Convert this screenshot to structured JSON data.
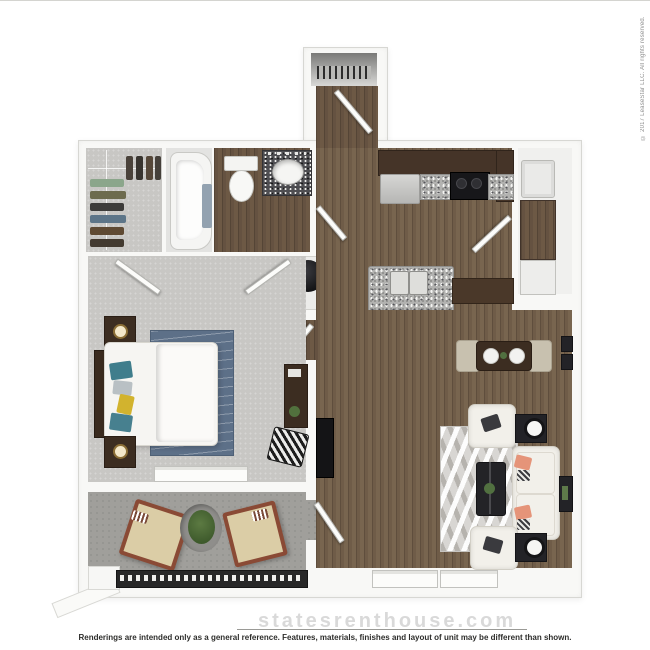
{
  "copyright": "© 2017 LeaseStar LLC. All rights reserved.",
  "footer": {
    "watermark": "statesrenthouse.com",
    "disclaimer": "Renderings are intended only as a general reference. Features, materials, finishes and layout of unit may be different than shown."
  },
  "floorplan": {
    "view": "3d-top-down-rendering",
    "unit_type": "one-bedroom one-bath apartment with balcony",
    "rooms": [
      {
        "name": "entry",
        "floor": "wood",
        "features": [
          "coat-closet-with-hangers",
          "entry-door"
        ]
      },
      {
        "name": "walk-in-closet",
        "floor": "carpet",
        "features": [
          "hanging-clothes"
        ]
      },
      {
        "name": "shower-room",
        "floor": "tile",
        "features": [
          "bathtub",
          "towel"
        ]
      },
      {
        "name": "bathroom",
        "floor": "wood",
        "features": [
          "toilet",
          "granite-vanity-sink"
        ]
      },
      {
        "name": "utility-closet",
        "floor": "tile",
        "features": [
          "water-heater"
        ]
      },
      {
        "name": "kitchen",
        "floor": "wood",
        "features": [
          "upper-cabinets",
          "refrigerator",
          "range",
          "granite-counters",
          "island-double-sink",
          "breakfast-bar",
          "two-stools"
        ]
      },
      {
        "name": "laundry-room",
        "floor": "wood",
        "features": [
          "washer",
          "dryer",
          "counter"
        ]
      },
      {
        "name": "dining-area",
        "floor": "wood",
        "features": [
          "table",
          "two-chairs",
          "two-place-settings",
          "wall-art"
        ]
      },
      {
        "name": "living-room",
        "floor": "wood",
        "features": [
          "sofa",
          "two-armchairs",
          "coffee-table",
          "two-side-tables-with-lamps",
          "chevron-rug",
          "tv-console",
          "wall-art",
          "two-windows"
        ]
      },
      {
        "name": "bedroom",
        "floor": "carpet",
        "features": [
          "bed",
          "headboard",
          "two-nightstands-with-lamps",
          "blue-rug",
          "dresser-with-plant",
          "chevron-ottoman",
          "window",
          "double-doors"
        ]
      },
      {
        "name": "balcony-patio",
        "floor": "concrete",
        "features": [
          "two-lounge-chairs",
          "planter",
          "railing"
        ]
      }
    ],
    "colors": {
      "wood_floor": "#6f5c48",
      "dark_cabinets": "#453428",
      "granite_light": "#b2b2b0",
      "granite_dark": "#4e4e52",
      "carpet": "#c8c7c4",
      "patio_concrete": "#a09f9b",
      "walls": "#f8f8f6",
      "rug_blue": "#5d7088",
      "accent_coral_pillow": "#e59479",
      "accent_teal_pillow": "#3f7d8c",
      "accent_yellow_pillow": "#d2b32e"
    }
  }
}
